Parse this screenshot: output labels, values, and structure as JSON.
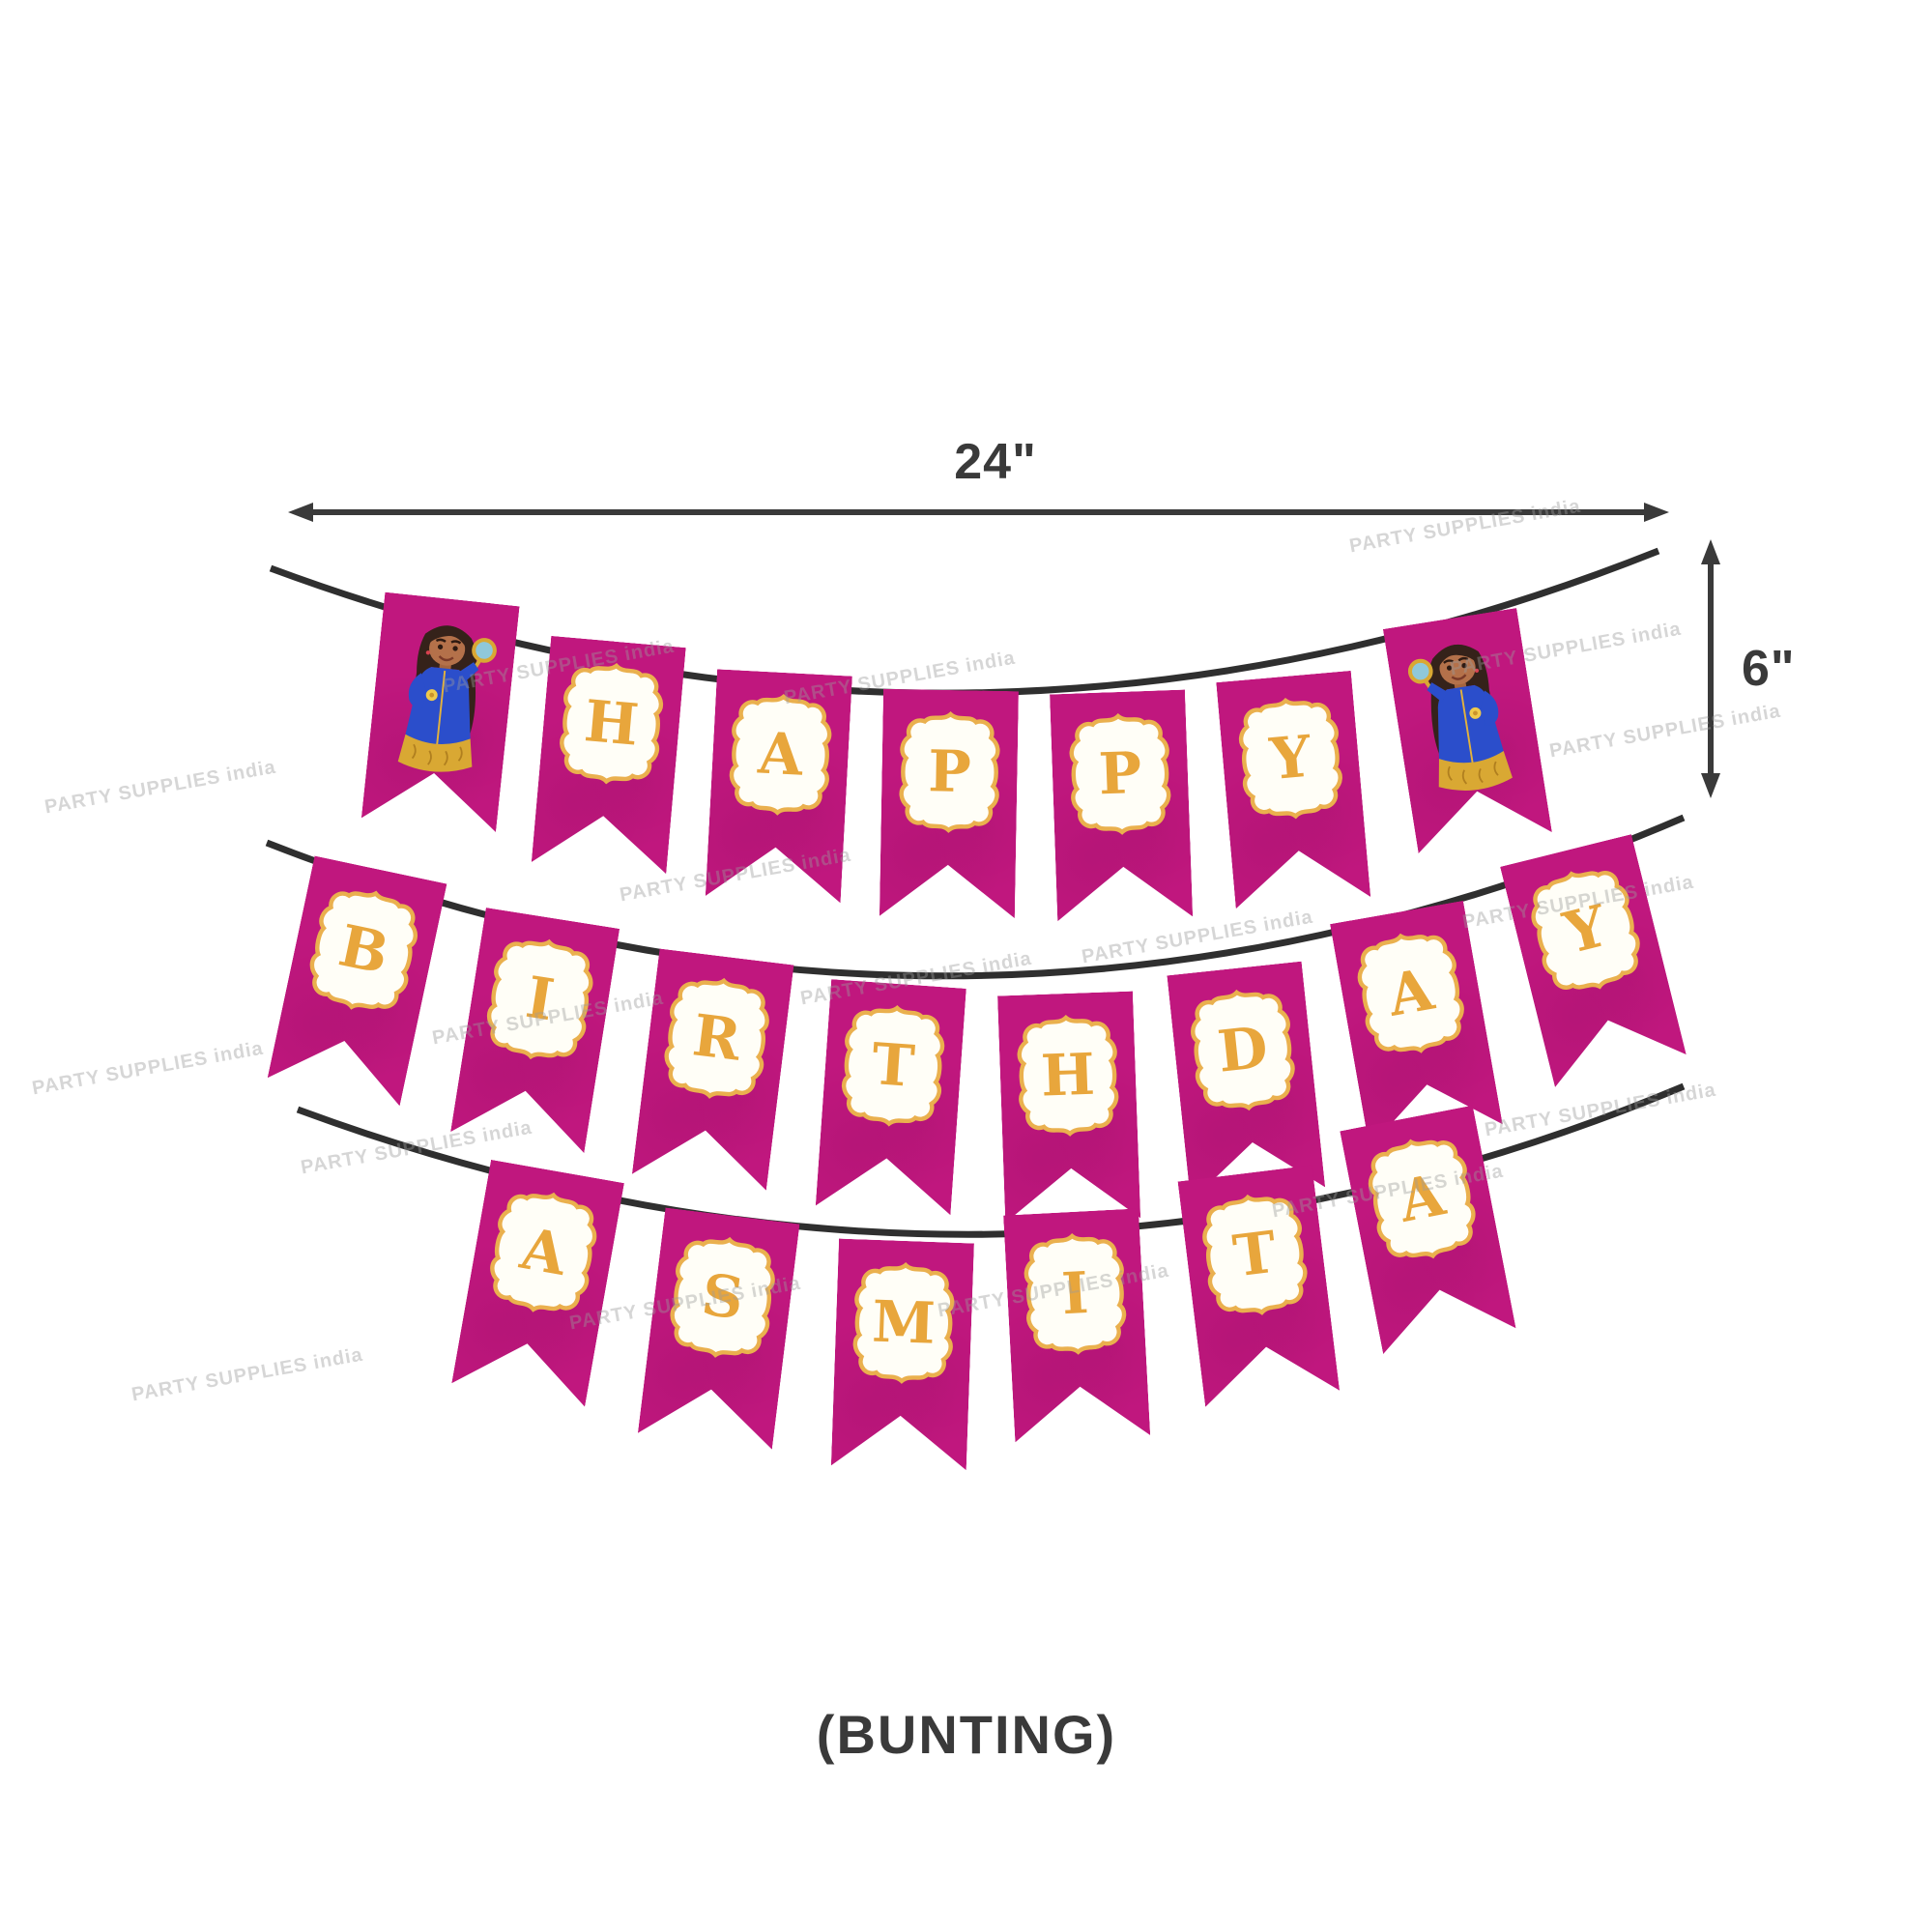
{
  "page": {
    "background_color": "#ffffff",
    "caption": "(BUNTING)"
  },
  "dimension_annotations": {
    "width_label": "24\"",
    "height_label": "6\""
  },
  "watermark": {
    "text": "PARTY SUPPLIES india"
  },
  "banner": {
    "theme": "girl-detective-birthday-bunting",
    "colors": {
      "flag_magenta": "#c0177e",
      "letter_gold": "#e8a63c",
      "plaque_border_gold": "#eab04e",
      "plaque_fill": "#fffef7",
      "string_dark": "#3a3a3a",
      "dress_blue": "#2b4ecb",
      "lens_teal": "#8fc8da"
    },
    "character_icon": "girl-detective-with-magnifying-glass",
    "rows": [
      {
        "word": "HAPPY",
        "letters": [
          "H",
          "A",
          "P",
          "P",
          "Y"
        ],
        "end_flags": "character-both-ends"
      },
      {
        "word": "BIRTHDAY",
        "letters": [
          "B",
          "I",
          "R",
          "T",
          "H",
          "D",
          "A",
          "Y"
        ],
        "end_flags": "none"
      },
      {
        "word": "ASMITA",
        "letters": [
          "A",
          "S",
          "M",
          "I",
          "T",
          "A"
        ],
        "end_flags": "none"
      }
    ]
  }
}
